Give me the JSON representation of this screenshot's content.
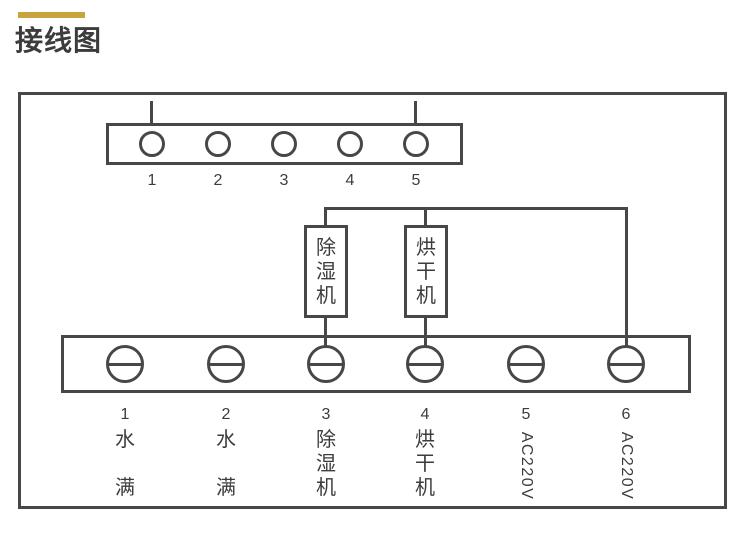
{
  "colors": {
    "accent": "#C9A33C",
    "line": "#474747",
    "text": "#3C3C3C"
  },
  "header": {
    "title": "接线图"
  },
  "diagram": {
    "top_connector": {
      "numbers": [
        "1",
        "2",
        "3",
        "4",
        "5"
      ]
    },
    "devices": [
      {
        "label": "除湿机",
        "chars": [
          "除",
          "湿",
          "机"
        ]
      },
      {
        "label": "烘干机",
        "chars": [
          "烘",
          "干",
          "机"
        ]
      }
    ],
    "bottom": {
      "terminals": [
        {
          "number": "1",
          "label": "水满",
          "chars": [
            "水",
            "满"
          ]
        },
        {
          "number": "2",
          "label": "水满",
          "chars": [
            "水",
            "满"
          ]
        },
        {
          "number": "3",
          "label": "除湿机",
          "chars": [
            "除",
            "湿",
            "机"
          ]
        },
        {
          "number": "4",
          "label": "烘干机",
          "chars": [
            "烘",
            "干",
            "机"
          ]
        },
        {
          "number": "5",
          "label": "AC220V"
        },
        {
          "number": "6",
          "label": "AC220V"
        }
      ]
    }
  }
}
